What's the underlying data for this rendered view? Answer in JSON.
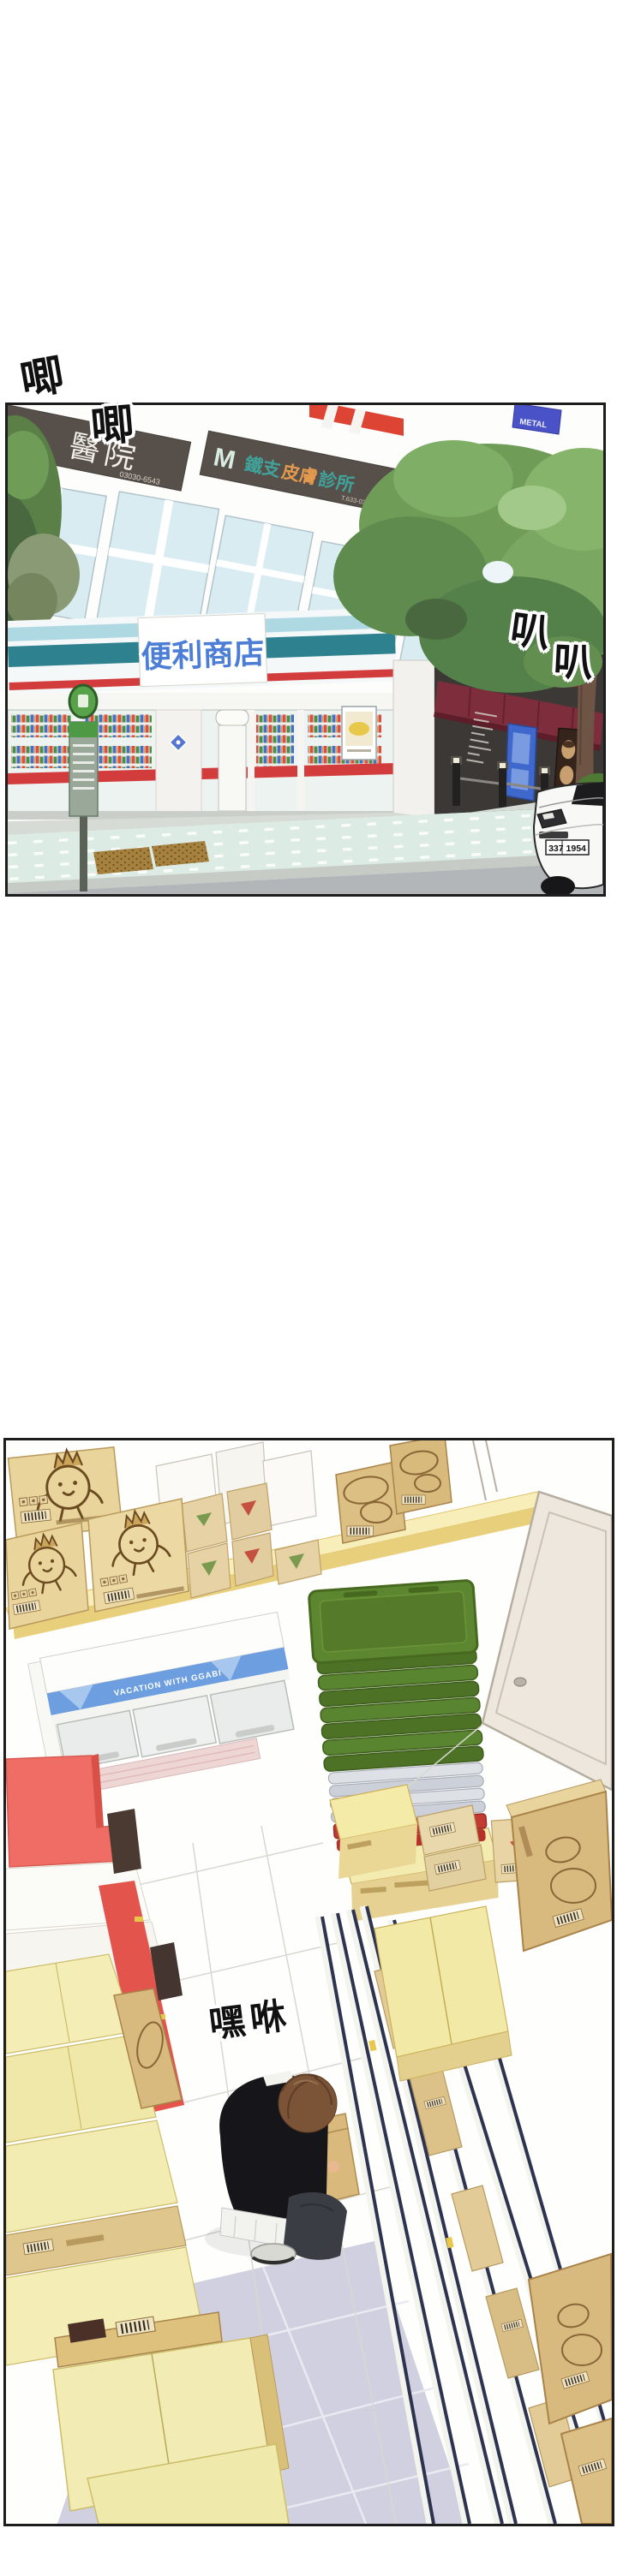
{
  "sfx": {
    "ji_1": "唧",
    "ji_2": "唧",
    "ba_1": "叭",
    "ba_2": "叭",
    "heave": "嘿咻"
  },
  "panel1": {
    "hospital_sign": {
      "text": "醫院",
      "phone": "03030-6543"
    },
    "clinic_sign": {
      "logo": "M",
      "name_part1": "鐵支",
      "name_part2": "皮膚",
      "name_part3": "診所",
      "phone": "T.633-03030-6543"
    },
    "metal_sign": "METAL",
    "store_sign": "便利商店",
    "car_plate": "337 1954"
  },
  "panel2": {
    "freezer_banner": "VACATION WITH GGABI"
  },
  "colors": {
    "panel_border": "#1d1d1d",
    "sign_dark": "#57504a",
    "clinic_teal": "#3fa39b",
    "clinic_orange": "#e39a4e",
    "metal_blue": "#4a52c8",
    "store_text_blue": "#4d7ed6",
    "awning_teal_dark": "#2e818f",
    "awning_teal_light": "#aed8e2",
    "stripe_red": "#d23c3c",
    "cafe_awning_red": "#7d2d3c",
    "cafe_wall": "#3b3836",
    "door_blue": "#3f68cc",
    "tree_green": "#6f9d58",
    "sidewalk_mint": "#dcebe3",
    "road_gray": "#b2b6b9",
    "mat_brown": "#a5803e",
    "crate_green": "#55802c",
    "basket_red": "#c23b33",
    "shelf_yellow": "#f5e49c",
    "carton_tan": "#e3c98f",
    "freezer_band_blue": "#6d9fe0",
    "end_panel_red": "#ee6a62",
    "floor_lavender": "#d0d0e0",
    "rail_navy": "#2e3450",
    "shirt_black": "#16161a",
    "hair_brown": "#7b5336"
  }
}
